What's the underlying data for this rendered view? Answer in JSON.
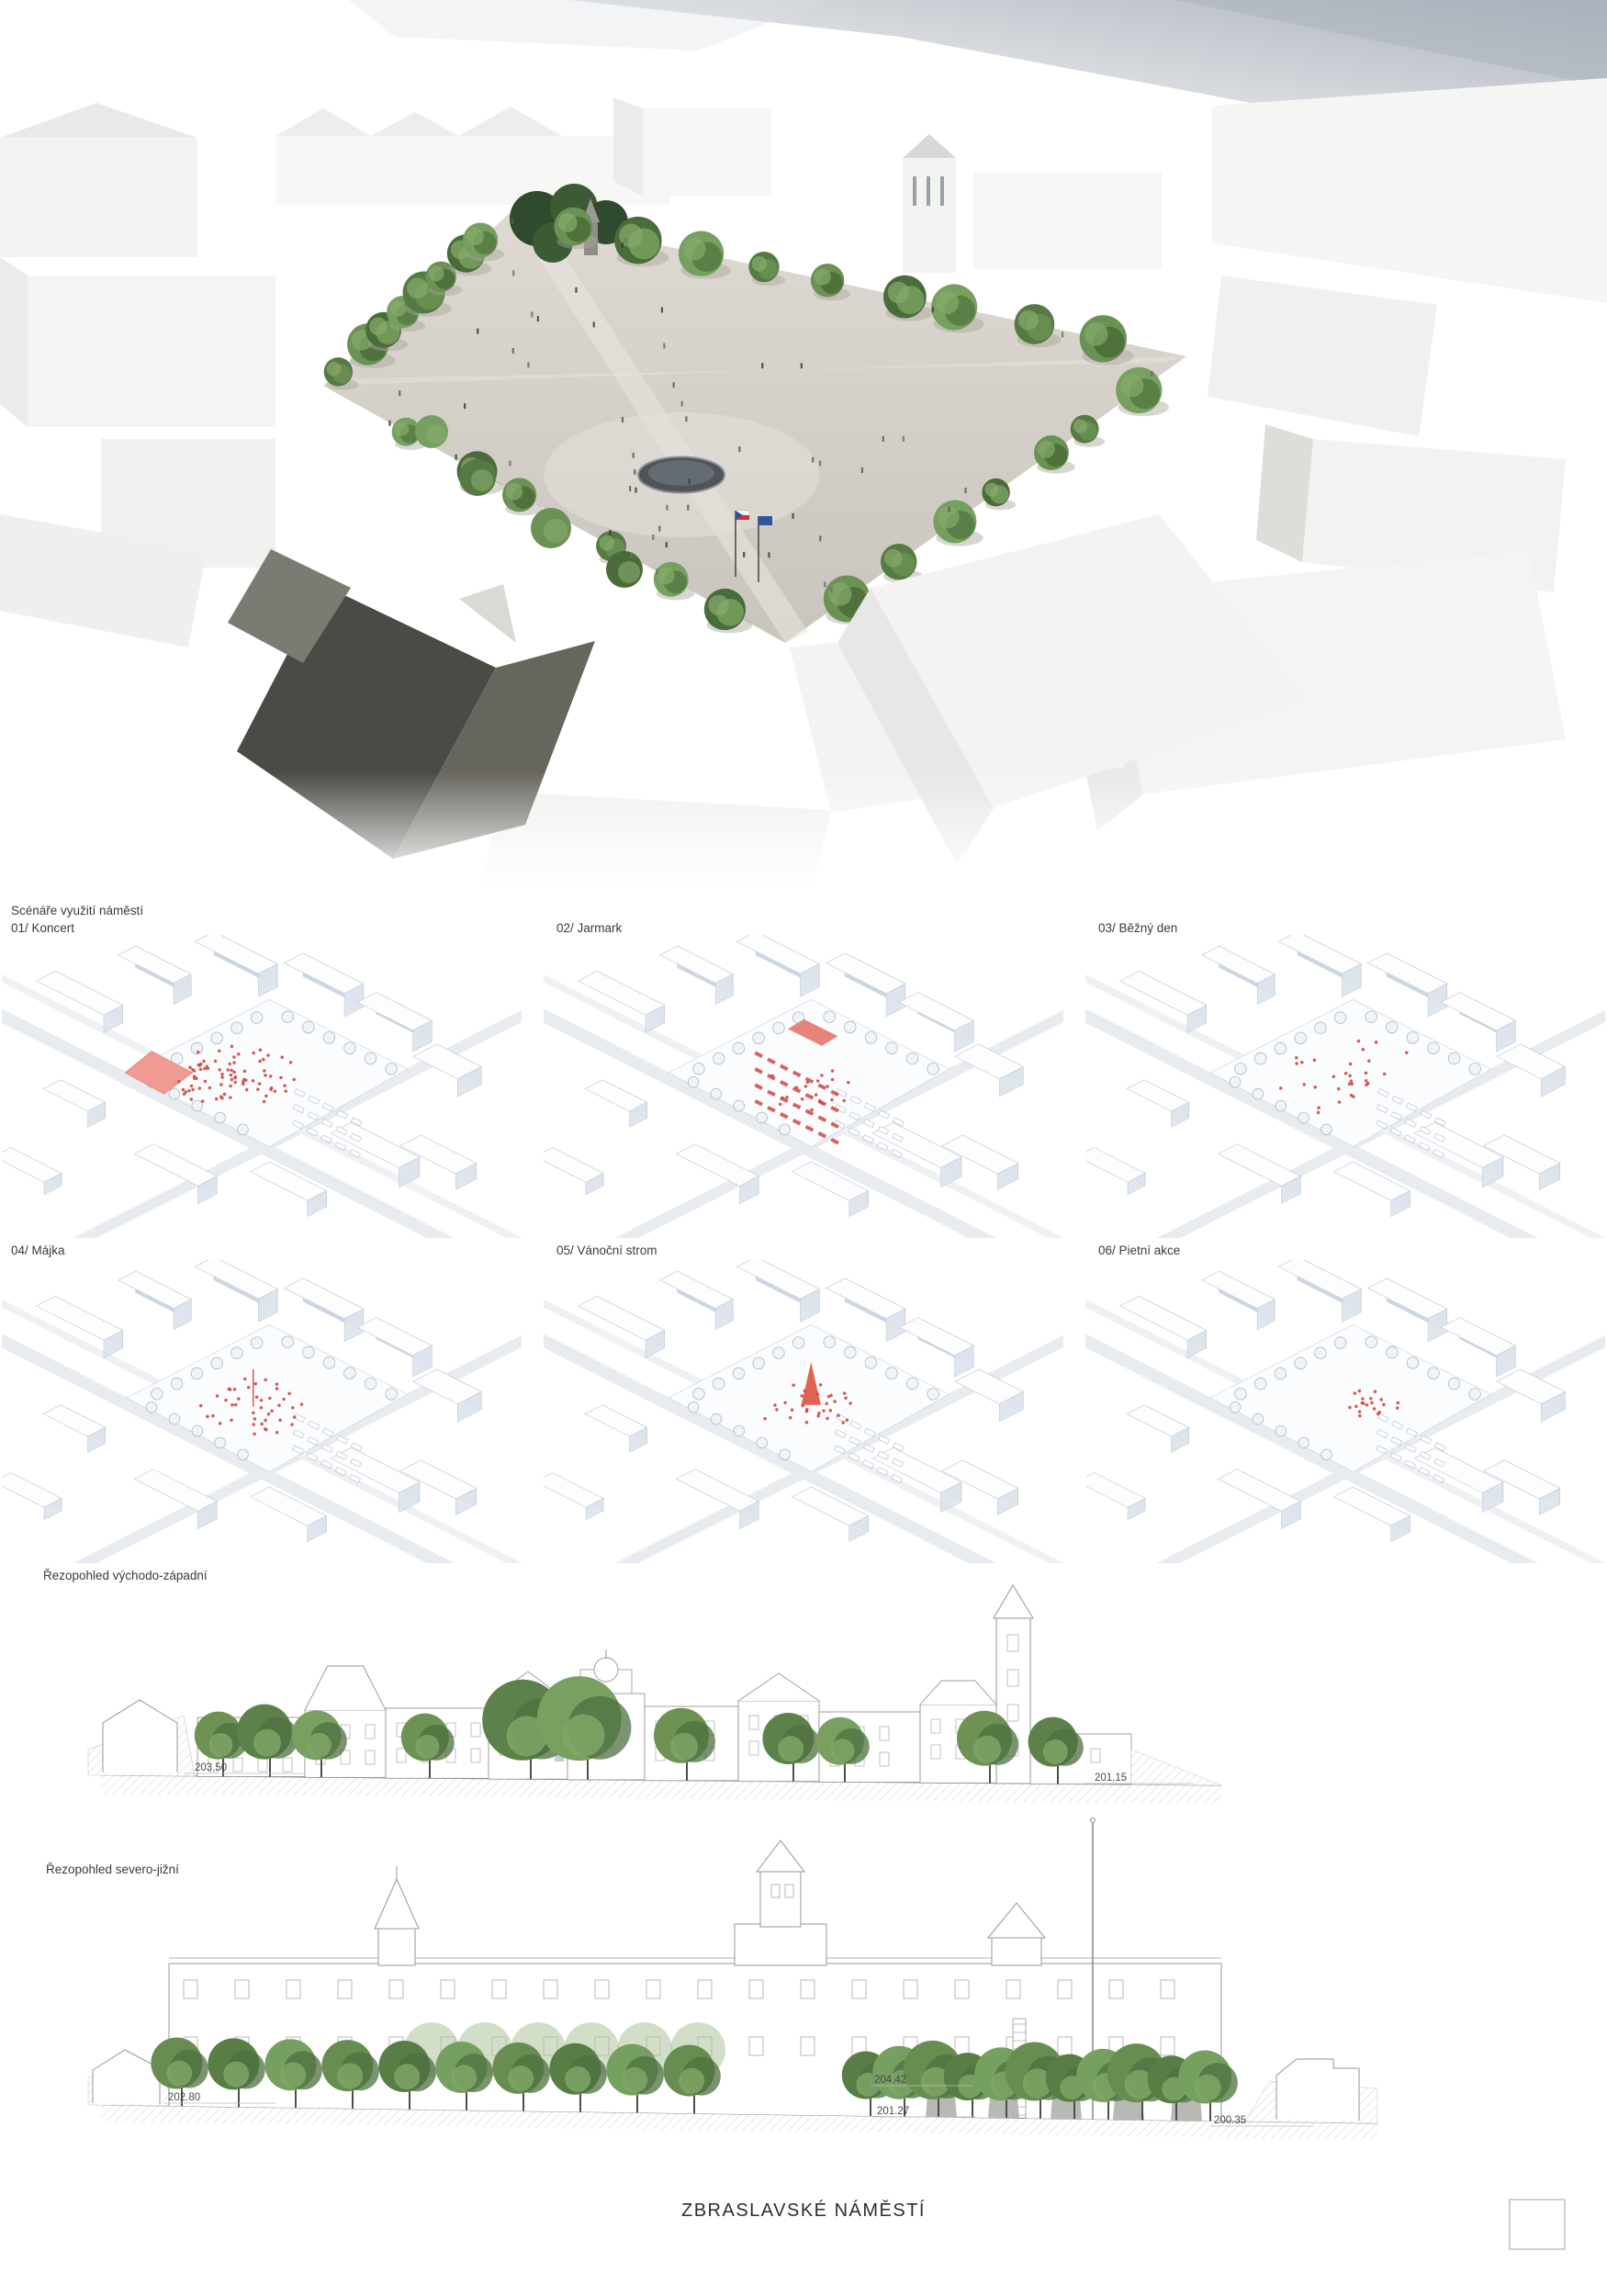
{
  "board_title": "ZBRASLAVSKÉ NÁMĚSTÍ",
  "scenarios": {
    "heading": "Scénáře využití náměstí",
    "items": [
      {
        "label": "01/ Koncert",
        "accent": "stage-crowd"
      },
      {
        "label": "02/ Jarmark",
        "accent": "market-stalls"
      },
      {
        "label": "03/ Běžný den",
        "accent": "scattered-people"
      },
      {
        "label": "04/ Májka",
        "accent": "maypole-crowd"
      },
      {
        "label": "05/ Vánoční strom",
        "accent": "christmas-tree"
      },
      {
        "label": "06/ Pietní akce",
        "accent": "memorial-gathering"
      }
    ]
  },
  "sections": [
    {
      "label": "Řezopohled východo-západní",
      "levels": {
        "left": "203.50",
        "right": "201.15"
      }
    },
    {
      "label": "Řezopohled severo-jižní",
      "levels": {
        "left": "202.80",
        "mid_upper": "204.42",
        "mid_lower": "201.27",
        "right": "200.35"
      }
    }
  ],
  "colors": {
    "accent_red": "#cf4840",
    "tree_green": "#678e50",
    "axon_shade": "#ccd6e3",
    "paving": "#d6d2cb"
  }
}
